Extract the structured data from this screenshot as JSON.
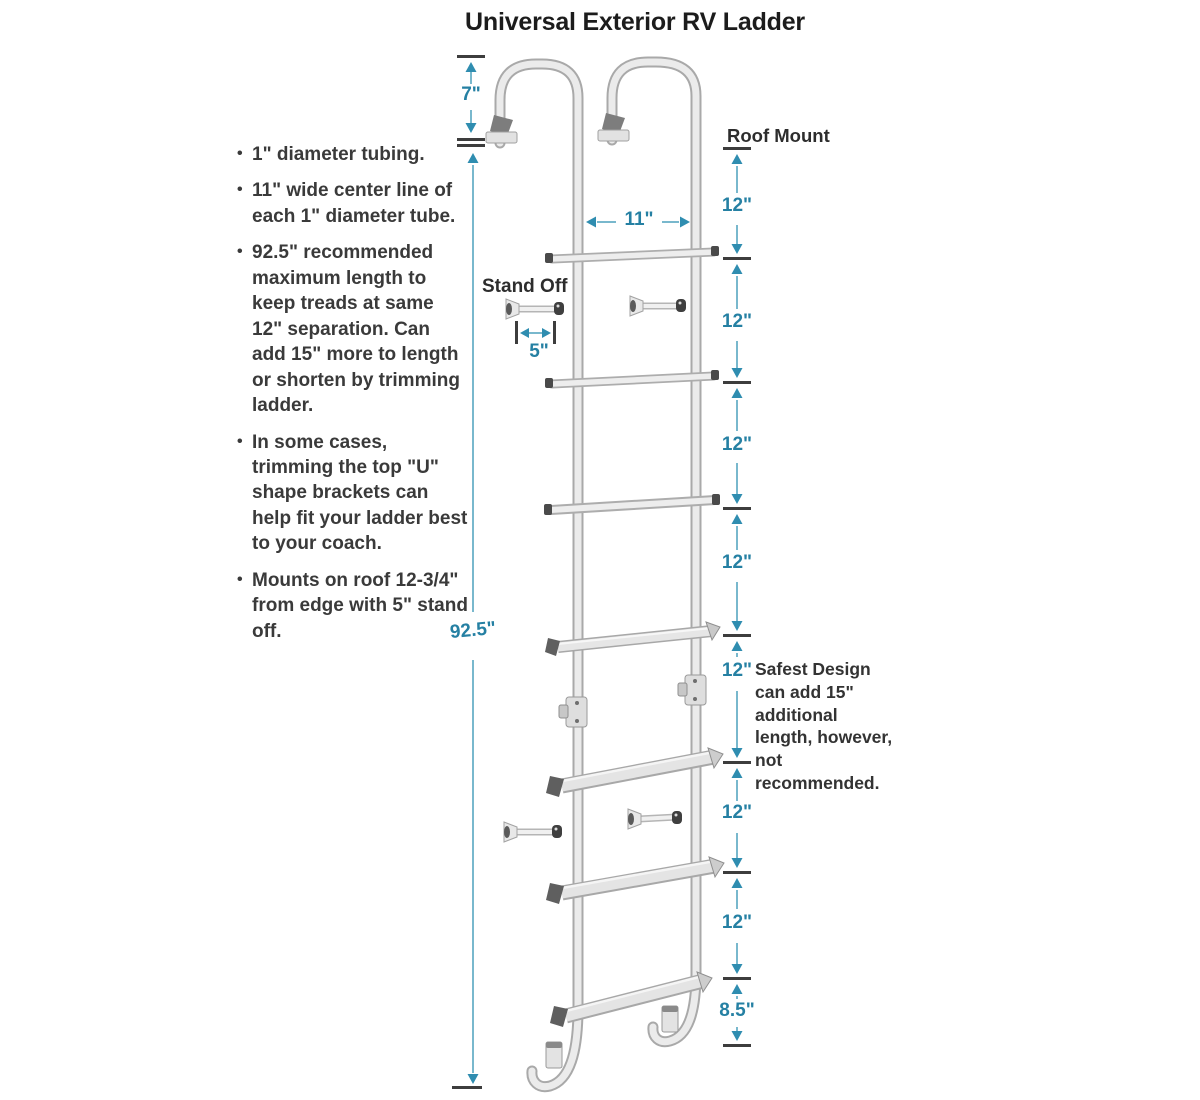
{
  "title": "Universal Exterior RV Ladder",
  "specs": [
    "1\" diameter tubing.",
    "11\" wide center line of each 1\" diameter tube.",
    "92.5\" recommended maximum length to keep treads at same 12\" separation. Can add 15\" more to length or shorten by trimming ladder.",
    "In some cases, trimming the top \"U\" shape brackets can help fit your ladder best to your coach.",
    "Mounts on roof 12-3/4\" from edge with 5\" stand off."
  ],
  "labels": {
    "roof_mount": "Roof Mount",
    "stand_off": "Stand Off",
    "top_clearance": "7\"",
    "rail_width": "11\"",
    "overall_height": "92.5\"",
    "standoff_length": "5\"",
    "note": "Safest Design can add 15\" additional length, however, not recommended."
  },
  "right_dims": [
    "12\"",
    "12\"",
    "12\"",
    "12\"",
    "12\"",
    "12\"",
    "12\"",
    "8.5\""
  ],
  "colors": {
    "accent_teal": "#2580a3",
    "line_teal": "#79b8cd",
    "arrow_teal": "#2f8db0",
    "tick_dark": "#3d3d3d",
    "text_dark": "#2d2d2d",
    "ladder_light": "#ebebeb",
    "ladder_shade": "#a9a9a9"
  }
}
